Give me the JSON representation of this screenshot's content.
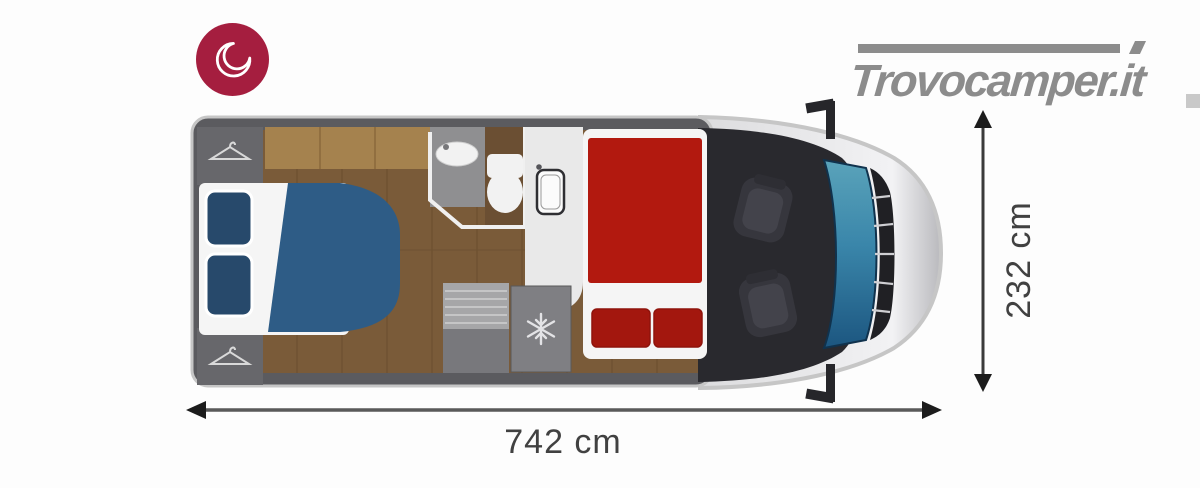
{
  "branding": {
    "logo_text": "Trovocamper.it",
    "badge_icon": "crescent-moon-icon"
  },
  "dimensions": {
    "length_label": "742 cm",
    "width_label": "232 cm"
  },
  "floorplan": {
    "type": "camper-motorhome-top-view",
    "features": [
      "rear-double-bed-blue",
      "two-blue-pillows",
      "wardrobe-top",
      "wardrobe-bottom",
      "overhead-cabinets",
      "bathroom-sink",
      "toilet",
      "kitchen-counter",
      "kitchen-sink",
      "entry-steps",
      "fridge-freezer",
      "front-double-bed-red",
      "two-red-pillows",
      "driver-seat",
      "passenger-seat",
      "windshield",
      "front-grille",
      "side-mirrors"
    ]
  },
  "colors": {
    "background": "#fdfdfd",
    "badge": "#a51e3f",
    "logoGray": "#8c8c8c",
    "edgeMark": "#c9c9c9",
    "chrome": "#c6c6c6",
    "wall": "#5b5b5f",
    "wardrobe": "#67676b",
    "wood": "#7a5b39",
    "woodSeam": "#63482b",
    "cabinet": "#a5824e",
    "cabinetSeam": "#8a693c",
    "tile": "#8f8f91",
    "bathFloor": "#6b4f33",
    "fixtureWhite": "#f2f2f2",
    "counter": "#e9e9e9",
    "sinkOutline": "#2f2f33",
    "stepsTop": "#a6a6a8",
    "stepsBottom": "#78787c",
    "fridge": "#7f7f83",
    "snowflake": "#e3e3e6",
    "bedBlue": "#2e5c86",
    "pillowBlue": "#27496b",
    "sheetWhite": "#f5f5f5",
    "bedRed": "#b2190f",
    "pillowRed": "#a3170e",
    "cabDark": "#29292e",
    "seat": "#36363d",
    "windshieldLight": "#5aa3ba",
    "windshieldDark": "#1c5680",
    "grille": "#202024",
    "arrow": "#5a5a5a",
    "arrowHead": "#1c1c1c",
    "dimText": "#414141"
  }
}
